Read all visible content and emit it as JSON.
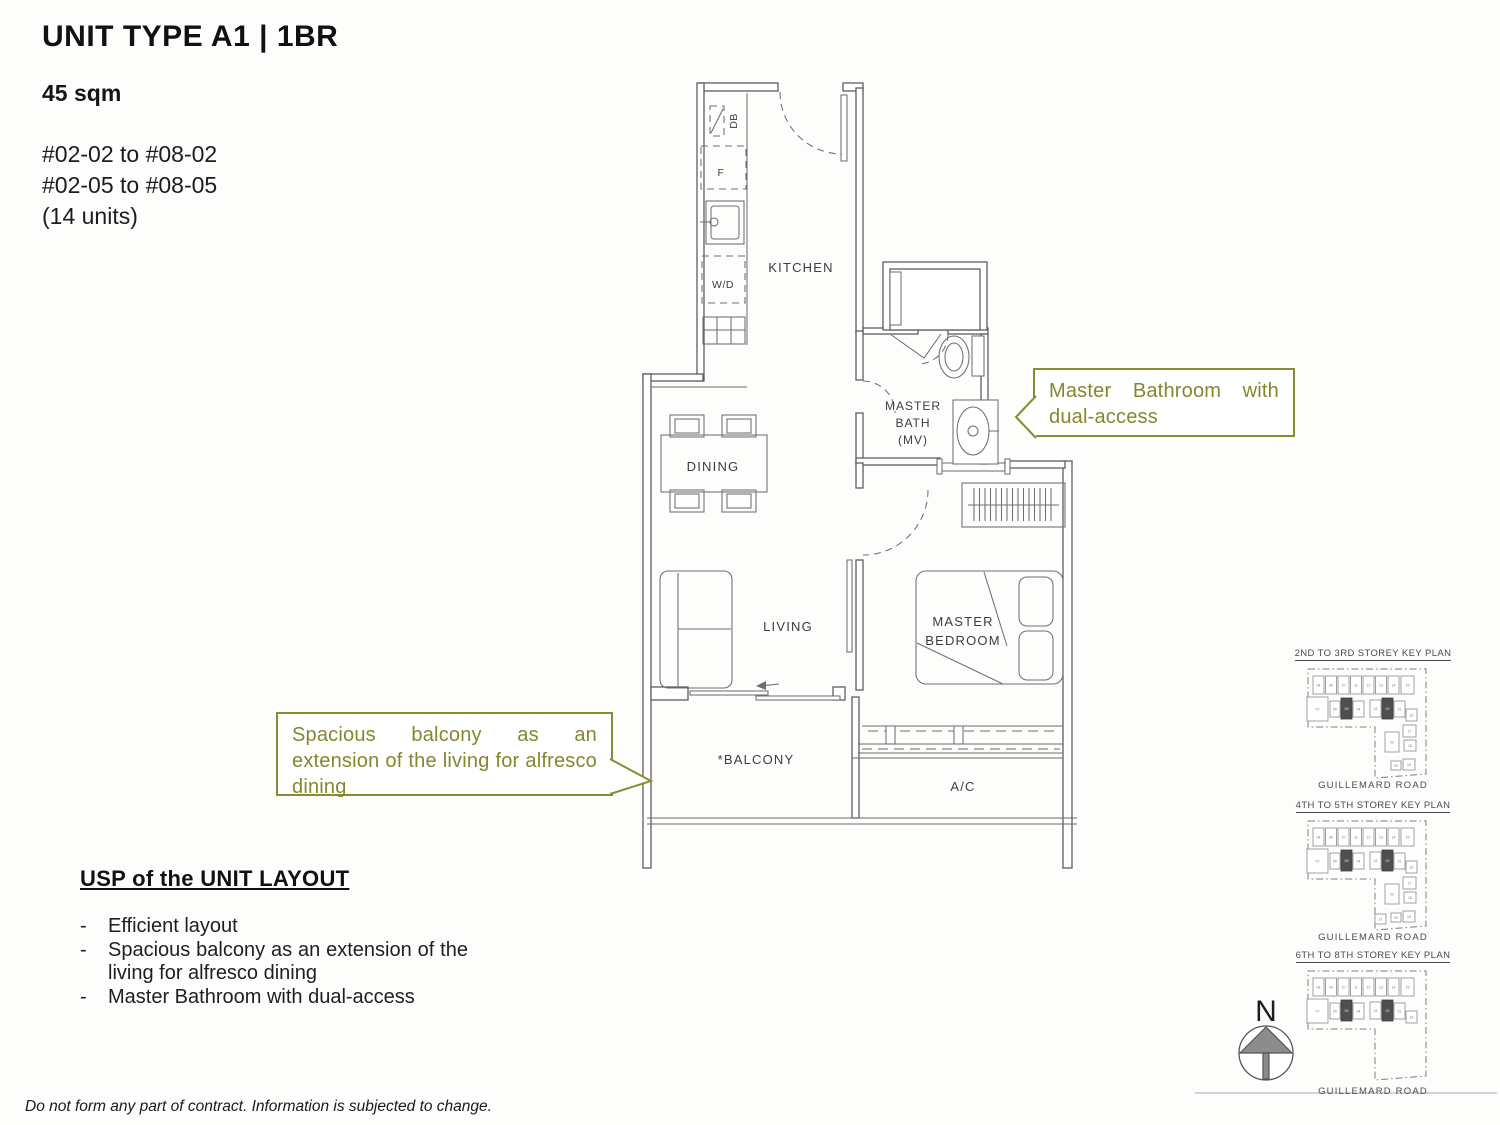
{
  "header": {
    "title": "UNIT TYPE A1 | 1BR",
    "area": "45 sqm",
    "stack_lines": [
      "#02-02 to #08-02",
      "#02-05 to #08-05",
      "(14 units)"
    ]
  },
  "floorplan": {
    "labels": {
      "kitchen": "KITCHEN",
      "dining": "DINING",
      "living": "LIVING",
      "balcony": "*BALCONY",
      "ac": "A/C",
      "bath1": "MASTER",
      "bath2": "BATH",
      "bath3": "(MV)",
      "bed1": "MASTER",
      "bed2": "BEDROOM",
      "db": "DB",
      "fridge": "F",
      "washer_dryer": "W/D"
    }
  },
  "callouts": {
    "bath": "Master Bathroom with dual-access",
    "balcony": "Spacious balcony as an extension of the living for alfresco dining"
  },
  "usp": {
    "heading": "USP of the UNIT LAYOUT",
    "items": [
      "Efficient layout",
      "Spacious balcony as an extension of the living for alfresco dining",
      "Master Bathroom with dual-access"
    ]
  },
  "key_plans": [
    {
      "title": "2ND TO 3RD STOREY KEY PLAN",
      "road": "GUILLEMARD ROAD",
      "variant": "full",
      "wing": [
        "17",
        "18",
        "22",
        "20",
        "19"
      ]
    },
    {
      "title": "4TH TO 5TH STOREY KEY PLAN",
      "road": "GUILLEMARD ROAD",
      "variant": "full",
      "wing": [
        "17",
        "18",
        "22",
        "21",
        "20",
        "19"
      ]
    },
    {
      "title": "6TH TO 8TH STOREY KEY PLAN",
      "road": "GUILLEMARD ROAD",
      "variant": "top",
      "wing": []
    }
  ],
  "key_plan_units": {
    "top_row": [
      "08",
      "09",
      "10",
      "11",
      "12",
      "13",
      "14",
      "15"
    ],
    "mid_row": [
      "07",
      "06",
      "05",
      "04",
      "03",
      "02",
      "01"
    ],
    "unit_16": "16",
    "highlighted": [
      "05",
      "02"
    ]
  },
  "compass": {
    "label": "N"
  },
  "footer": {
    "disclaimer": "Do not form any part of contract. Information is subjected to change."
  },
  "colors": {
    "accent_olive": "#8a8b33",
    "plan_line": "#5e5e5e",
    "highlight_unit": "#4f4f4f"
  }
}
